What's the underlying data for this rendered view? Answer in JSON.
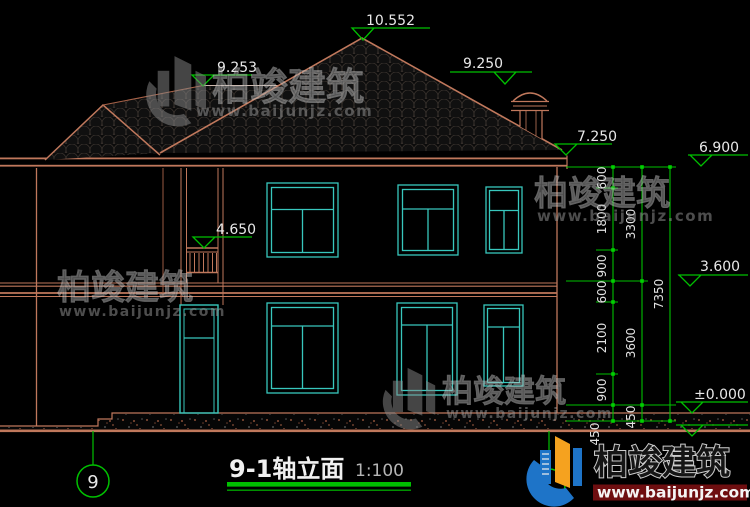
{
  "drawing": {
    "title": "9-1轴立面",
    "scale": "1:100",
    "axis_left_label": "9"
  },
  "elevations": {
    "main_ridge": "10.552",
    "left_ridge": "9.253",
    "chimney": "9.250",
    "eave_top": "7.250",
    "eave_bottom": "6.900",
    "balcony": "4.650",
    "second_floor": "3.600",
    "ground_floor": "±0.000"
  },
  "dimensions": {
    "col1": [
      "600",
      "1800",
      "900",
      "600",
      "2100",
      "900",
      "450"
    ],
    "col2": [
      "3300",
      "3600",
      "450"
    ],
    "col3": "7350"
  },
  "watermark": {
    "brand": "柏竣建筑",
    "url": "www.baijunjz.com"
  },
  "colors": {
    "wall_line": "#c0785c",
    "glazing": "#38c7bd",
    "dimension_green": "#00c000",
    "text_white": "#e8e8e8",
    "background": "#000000"
  }
}
